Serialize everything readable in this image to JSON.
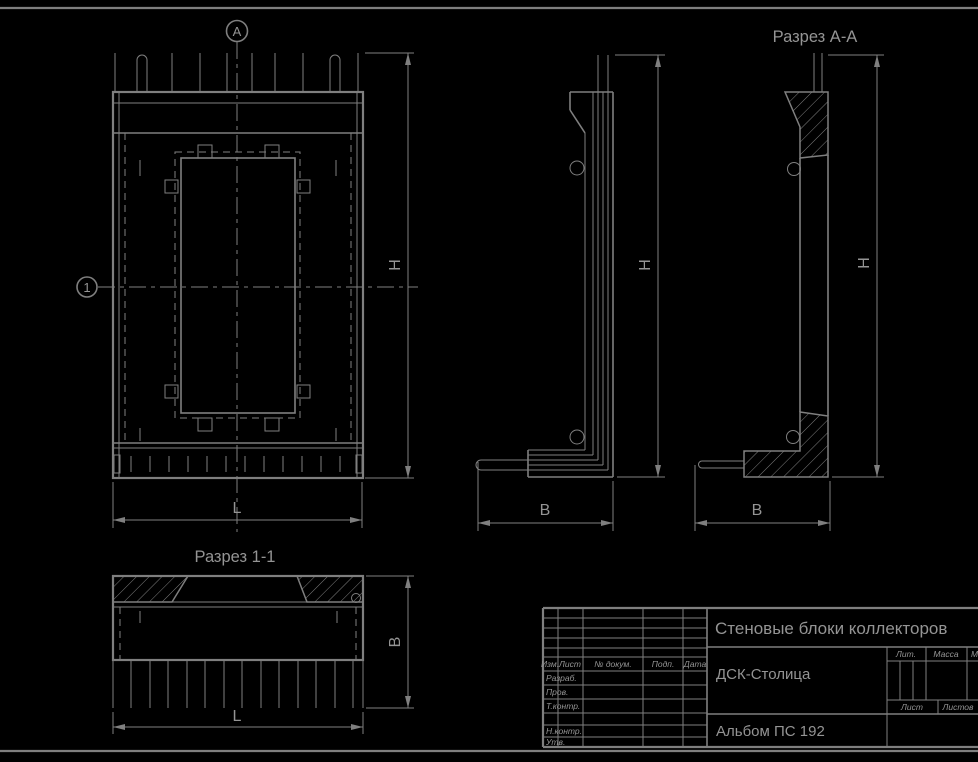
{
  "colors": {
    "background": "#000000",
    "line": "#7f7f7f",
    "text": "#949494"
  },
  "views": {
    "front": {
      "marker_top": "А",
      "marker_left": "1",
      "dim_height": "H",
      "dim_length": "L"
    },
    "side": {
      "dim_height": "H",
      "dim_width": "B"
    },
    "section_aa": {
      "title": "Разрез А-А",
      "dim_height": "H",
      "dim_width": "B"
    },
    "section_11": {
      "title": "Разрез 1-1",
      "dim_width": "B",
      "dim_length": "L"
    }
  },
  "title_block": {
    "doc_title": "Стеновые блоки коллекторов",
    "organization": "ДСК-Столица",
    "album": "Альбом ПС 192",
    "header_cols": {
      "izm": "Изм.",
      "list": "Лист",
      "doc": "№ докум.",
      "podp": "Подп.",
      "data": "Дата"
    },
    "rows": {
      "razrab": "Разраб.",
      "prov": "Пров.",
      "tkontr": "Т.контр.",
      "nkontr": "Н.контр.",
      "utv": "Утв."
    },
    "right": {
      "lit": "Лит.",
      "massa": "Масса",
      "masshtab": "Масштаб",
      "list": "Лист",
      "listov": "Листов"
    }
  }
}
